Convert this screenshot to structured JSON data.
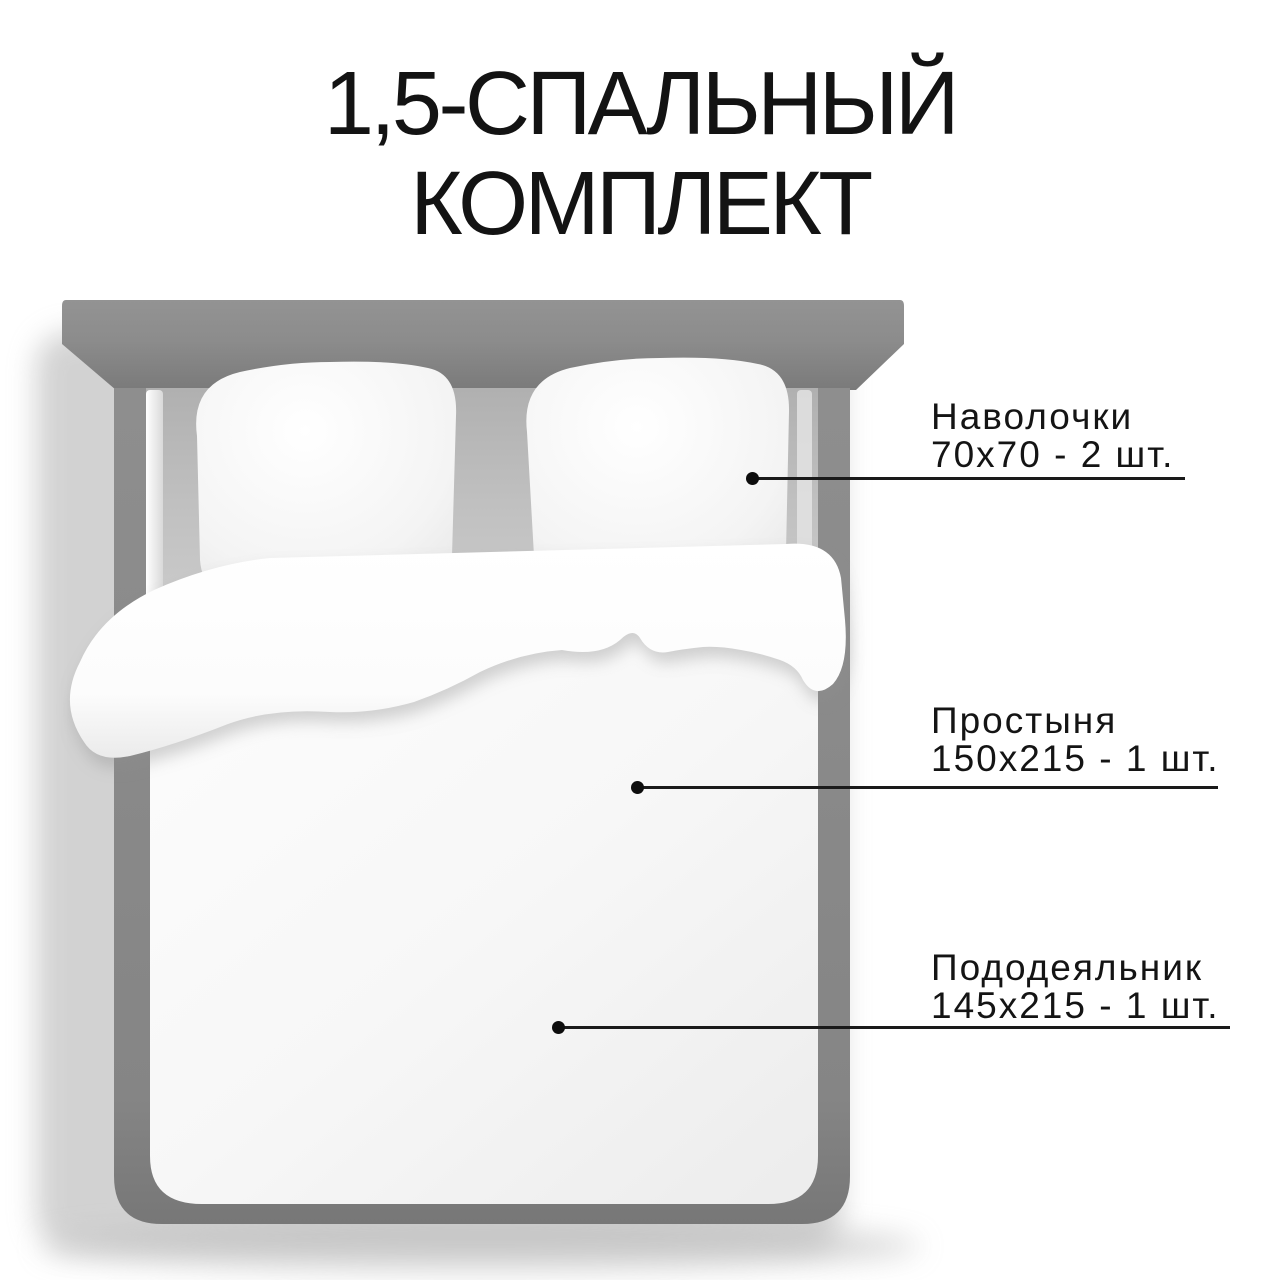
{
  "title": {
    "line1": "1,5-СПАЛЬНЫЙ",
    "line2": "КОМПЛЕКТ"
  },
  "callouts": {
    "pillowcases": {
      "label": "Наволочки",
      "size": "70х70 - 2 шт."
    },
    "sheet": {
      "label": "Простыня",
      "size": "150х215 - 1 шт."
    },
    "duvet_cover": {
      "label": "Пододеяльник",
      "size": "145х215 - 1 шт."
    }
  },
  "colors": {
    "background": "#ffffff",
    "text": "#141414",
    "callout_line": "#1a1a1a",
    "headboard_gray": "#888888",
    "bed_frame_gray": "#848484",
    "mattress_gray": "#c6c6c6",
    "bedding_white": "#ffffff"
  }
}
